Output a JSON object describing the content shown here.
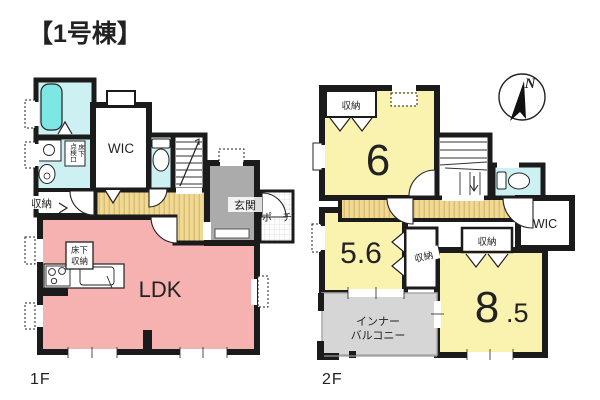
{
  "title": "【1号棟】",
  "compass": {
    "north_label": "N"
  },
  "floor1": {
    "label": "1F",
    "ldk": "LDK",
    "wic": "WIC",
    "entrance": "玄関",
    "porch": "ポーチ",
    "closet": "収納",
    "underfloor_storage": [
      "床下",
      "収納"
    ],
    "inspection_hatch": [
      "床下",
      "点検口"
    ]
  },
  "floor2": {
    "label": "2F",
    "room6": "6",
    "room56": "5.6",
    "room85_whole": "8",
    "room85_fraction": ".5",
    "closet_room6": "収納",
    "closet_mid": "収納",
    "closet_room85": "収納",
    "wic": "WIC",
    "balcony": [
      "インナー",
      "バルコニー"
    ]
  },
  "colors": {
    "wall": "#1b1b1b",
    "ldk_pink": "#f6b1b1",
    "room_yellow": "#faf3af",
    "hall_tan": "#f0d994",
    "water_cyan": "#cdf1f3",
    "fixture_cyan": "#7de7e4",
    "entrance_gray": "#ababab",
    "balcony_gray": "#d6d6d6"
  }
}
